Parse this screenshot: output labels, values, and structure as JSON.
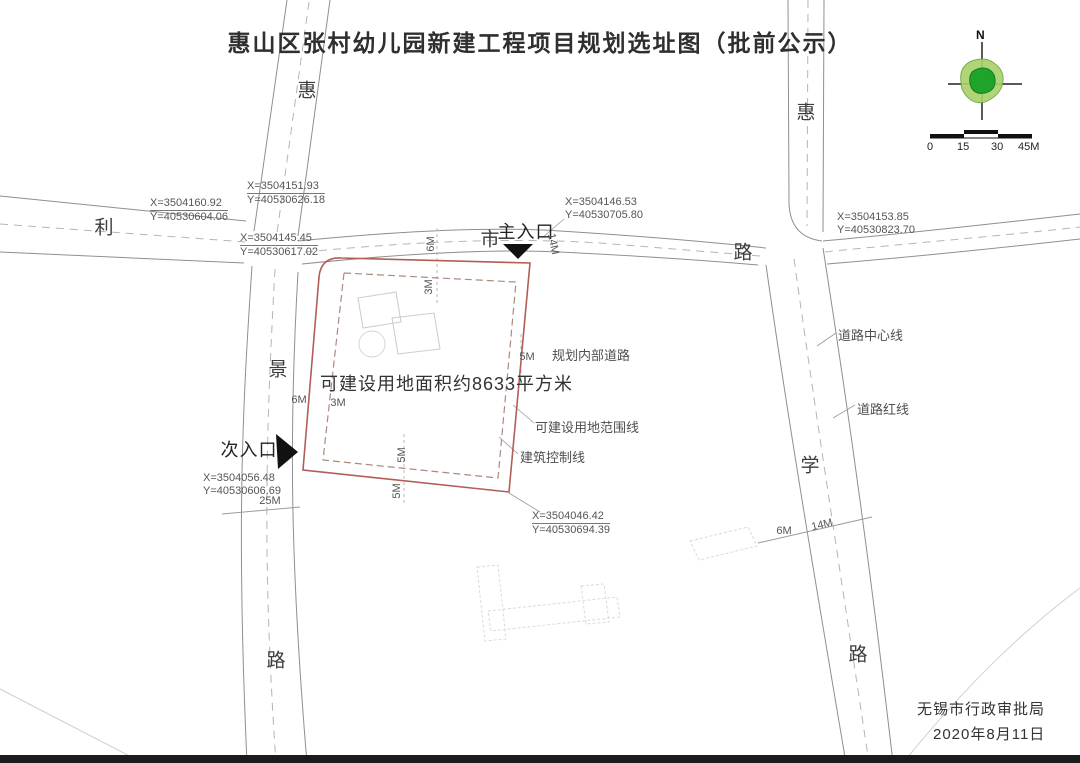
{
  "title": "惠山区张村幼儿园新建工程项目规划选址图（批前公示）",
  "compass": {
    "north": "N"
  },
  "scale_bar": {
    "labels": [
      "0",
      "15",
      "30",
      "45M"
    ]
  },
  "road_labels": [
    "惠",
    "利",
    "景",
    "路",
    "惠",
    "路",
    "学",
    "路",
    "市"
  ],
  "entrances": {
    "main": "主入口",
    "secondary": "次入口"
  },
  "site": {
    "area_note": "可建设用地面积约8633平方米"
  },
  "annotations": {
    "internal_road": "规划内部道路",
    "boundary_line": "可建设用地范围线",
    "control_line": "建筑控制线",
    "road_centerline": "道路中心线",
    "road_redline": "道路红线"
  },
  "coordinates": [
    {
      "x": "X=3504151.93",
      "y": "Y=40530626.18"
    },
    {
      "x": "X=3504160.92",
      "y": "Y=40530604.06"
    },
    {
      "x": "X=3504145.45",
      "y": "Y=40530617.02"
    },
    {
      "x": "X=3504146.53",
      "y": "Y=40530705.80"
    },
    {
      "x": "X=3504153.85",
      "y": "Y=40530823.70"
    },
    {
      "x": "X=3504056.48",
      "y": "Y=40530606.69"
    },
    {
      "x": "X=3504046.42",
      "y": "Y=40530694.39"
    }
  ],
  "dimensions": [
    "6M",
    "3M",
    "14M",
    "5M",
    "6M",
    "3M",
    "5M",
    "5M",
    "25M",
    "6M",
    "14M"
  ],
  "footer": {
    "agency": "无锡市行政审批局",
    "date": "2020年8月11日"
  },
  "colors": {
    "site_boundary": "#b25e55",
    "building_control": "#ab8a7e",
    "compass_outer": "#a8d168",
    "compass_inner": "#1fa32a",
    "entrance_marker": "#111111"
  }
}
